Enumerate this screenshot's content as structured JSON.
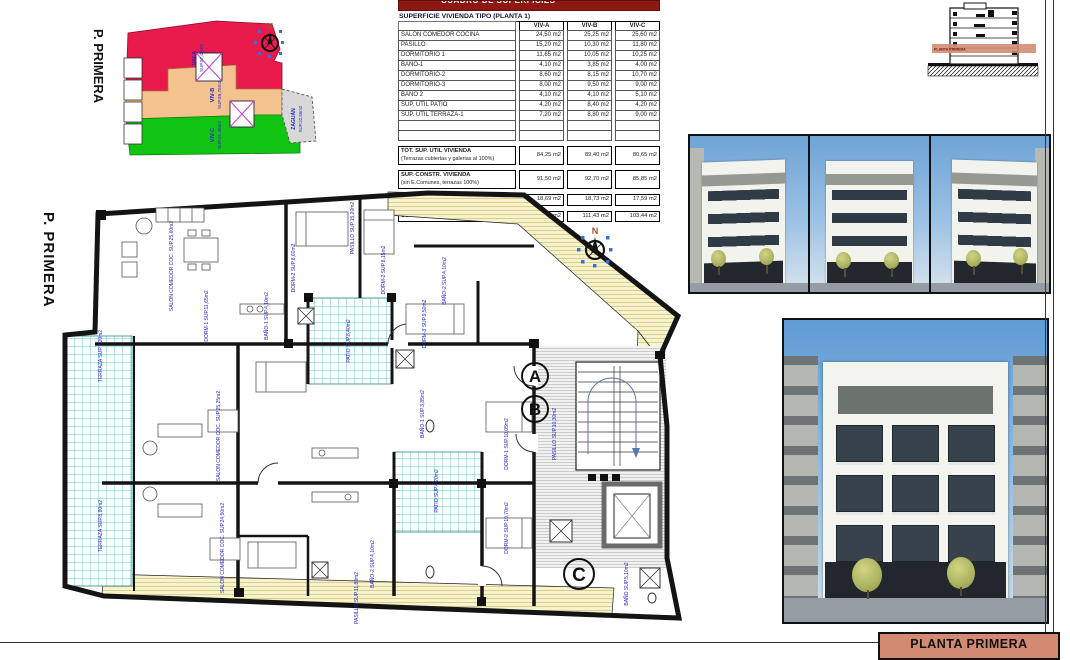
{
  "palette": {
    "viv_a_red": "#e91a4c",
    "viv_b_orange": "#f4c28e",
    "viv_c_green": "#12c412",
    "zaguan_gray": "#d8d8d8",
    "label_blue": "#2525c8",
    "band_salmon": "#d28a72",
    "table_title_red": "#8e1813"
  },
  "key_plan": {
    "floor_label": "P. PRIMERA",
    "compass_n": "N",
    "units": [
      {
        "name": "VIV-A",
        "area": "SUP.87,05m2"
      },
      {
        "name": "VIV-B",
        "area": "SUP.89,75m2"
      },
      {
        "name": "VIV-C",
        "area": "SUP.81,35m2"
      },
      {
        "name": "ZAGUÁN",
        "area": "SUP.32,55m2"
      }
    ]
  },
  "table": {
    "title_band": "CUADRO DE SUPERFICIES",
    "header": "SUPERFICIE VIVIENDA TIPO  (PLANTA 1)",
    "columns": [
      "VIV-A",
      "VIV-B",
      "VIV-C"
    ],
    "rows": [
      {
        "label": "SALON COMEDOR COCINA",
        "a": "24,50 m2",
        "b": "25,25 m2",
        "c": "25,60 m2"
      },
      {
        "label": "PASILLO",
        "a": "15,20 m2",
        "b": "10,30 m2",
        "c": "11,80 m2"
      },
      {
        "label": "DORMITORIO 1",
        "a": "11,65 m2",
        "b": "10,05 m2",
        "c": "10,25 m2"
      },
      {
        "label": "BAÑO-1",
        "a": "4,10 m2",
        "b": "3,85 m2",
        "c": "4,00 m2"
      },
      {
        "label": "DORMITORIO-2",
        "a": "8,60 m2",
        "b": "8,15 m2",
        "c": "10,70 m2"
      },
      {
        "label": "DORMITORIO-3",
        "a": "8,00 m2",
        "b": "9,50 m2",
        "c": "9,00 m2"
      },
      {
        "label": "BAÑO 2",
        "a": "4,10 m2",
        "b": "4,10 m2",
        "c": "5,10 m2"
      },
      {
        "label": "SUP. ÚTIL PATIO",
        "a": "4,20 m2",
        "b": "8,40 m2",
        "c": "4,20 m2"
      },
      {
        "label": "SUP. ÚTIL TERRAZA-1",
        "a": "7,20 m2",
        "b": "8,80 m2",
        "c": "9,00 m2"
      }
    ],
    "totals": [
      {
        "label": "TOT. SUP. UTIL VIVIENDA",
        "sub": "(Terrazas cubiertas y galerias al 100%)",
        "a": "84,25 m2",
        "b": "89,40 m2",
        "c": "80,65 m2"
      },
      {
        "label": "SUP. CONSTR. VIVIENDA",
        "sub": "(sin E.Comunes, terrazas 100%)",
        "a": "91,50 m2",
        "b": "92,70 m2",
        "c": "85,85 m2"
      },
      {
        "label": "SUP. CONSTRUIDA COMUNES",
        "sub": "",
        "a": "18,69 m2",
        "b": "18,73 m2",
        "c": "17,59 m2"
      },
      {
        "label": "SUPERFICIE CONSTRUIDA TOTAL",
        "sub": "",
        "a": "110,19 m2",
        "b": "111,43 m2",
        "c": "103,44 m2"
      }
    ]
  },
  "section_drawing": {
    "band_label": "PLANTA PRIMERA"
  },
  "floor_plan": {
    "floor_label": "P. PRIMERA",
    "compass_n": "N",
    "section_markers": [
      "A",
      "B",
      "C"
    ],
    "labels": [
      "PASILLO SUP.15,20m2",
      "SALON COMEDOR COC. SUP.25,60m2",
      "DORM-2 SUP.8,60m2",
      "DORM-1 SUP.11,65m2",
      "BAÑO-1 SUP.4,10m2",
      "TERRAZA SUP.7,20m2",
      "DORM-2 SUP.8,15m2",
      "BAÑO-2 SUP.4,10m2",
      "PATIO SUP.8,40m2",
      "DORM-3 SUP.9,50m2",
      "PASILLO SUP.10,30m2",
      "DORM-1 SUP.10,05m2",
      "DORM-2 SUP.10,70m2",
      "PATIO SUP.4,20m2",
      "BAÑO-1 SUP.3,85m2",
      "BAÑO-2 SUP.4,10m2",
      "SALON COMEDOR COC. SUP.25,25m2",
      "SALON COMEDOR COC. SUP.24,50m2",
      "TERRAZA SUP.8,80m2",
      "PASILLO SUP.11,80m2",
      "BAÑO SUP.5,10m2"
    ]
  },
  "title_block": {
    "label": "PLANTA PRIMERA"
  }
}
